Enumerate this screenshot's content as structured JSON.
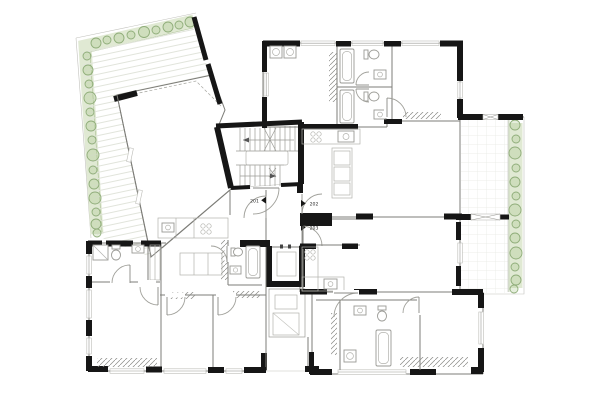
{
  "plan": {
    "type": "architectural-floor-plan",
    "unit_labels": {
      "left": "201",
      "top_right": "202",
      "bottom_right": "203"
    },
    "colors": {
      "background": "#ffffff",
      "wall": "#161616",
      "line": "#7d7d78",
      "planter_fill": "#e0e9d3",
      "plant_stroke": "#8fad79",
      "plant_fill": "rgba(170,200,140,0.30)",
      "label": "#2a2a2a"
    }
  }
}
